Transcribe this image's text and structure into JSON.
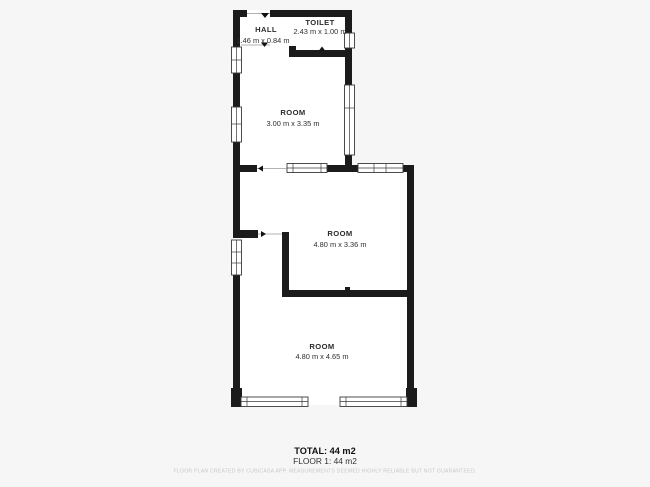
{
  "floor_plan": {
    "rooms": {
      "hall": {
        "name": "HALL",
        "dims": "1.46 m x 0.84 m"
      },
      "toilet": {
        "name": "TOILET",
        "dims": "2.43 m x 1.00 m"
      },
      "room_top": {
        "name": "ROOM",
        "dims": "3.00 m x 3.35 m"
      },
      "room_mid": {
        "name": "ROOM",
        "dims": "4.80 m x 3.36 m"
      },
      "room_bottom": {
        "name": "ROOM",
        "dims": "4.80 m x 4.65 m"
      }
    },
    "summary": {
      "total": "TOTAL: 44 m2",
      "floor": "FLOOR 1: 44 m2"
    },
    "disclaimer": "FLOOR PLAN CREATED BY CUBICASA APP. MEASUREMENTS DEEMED HIGHLY RELIABLE BUT NOT GUARANTEED.",
    "colors": {
      "wall": "#1b1b1b",
      "background": "#f6f6f6",
      "room_fill": "#ffffff",
      "label_text": "#2b2b2b",
      "disclaimer_text": "#c8c8c8"
    }
  }
}
